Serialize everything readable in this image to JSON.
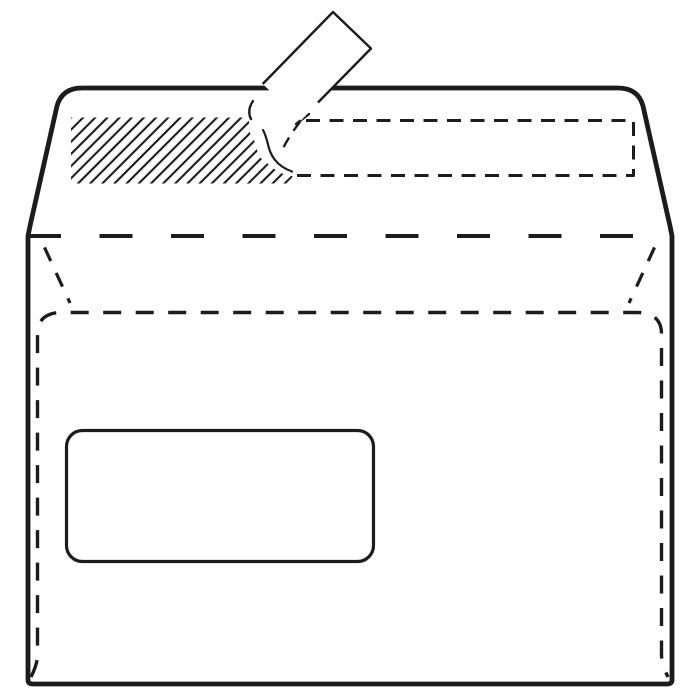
{
  "colors": {
    "background": "#ffffff",
    "line": "#1c1c1c"
  },
  "illustration": {
    "kind": "line-drawing",
    "parts": {
      "envelope_outline": "envelope-back-outline",
      "flap_fold_line": "top-flap-fold-line",
      "side_folds": "side-flap-fold-lines",
      "back_seam": "back-seam-dashed-outline",
      "seal_strip_outline": "seal-strip-dashed-outline",
      "adhesive_strip": "hatched-adhesive-strip",
      "peel_liner": "peel-liner-strip",
      "window": "address-window"
    }
  }
}
